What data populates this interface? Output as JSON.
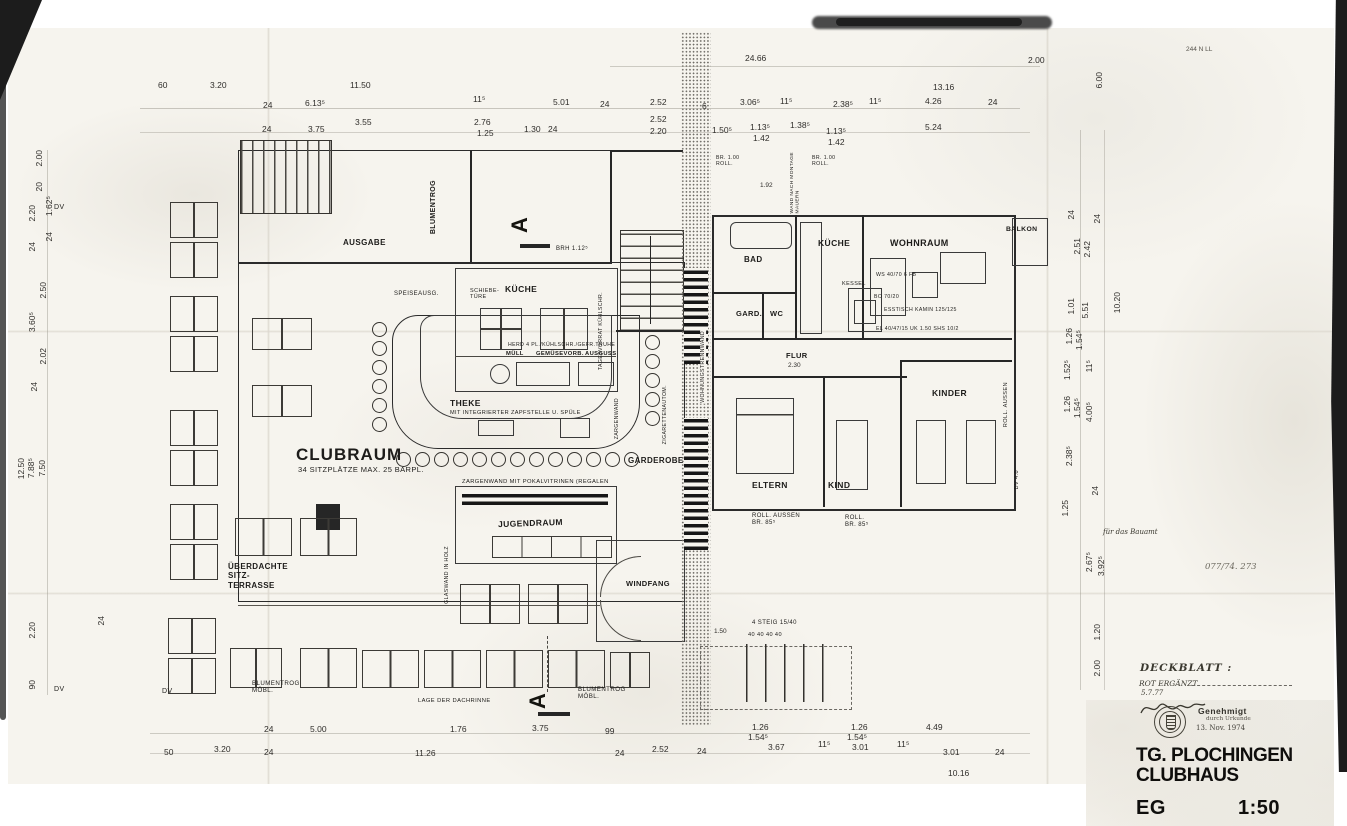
{
  "title_block": {
    "deckblatt": "DECKBLATT :",
    "revision": "ROT ERGÄNZT",
    "revision_date": "5.7.77",
    "stamp": "Genehmigt",
    "stamp_sub": "durch Urkunde",
    "stamp_date": "13. Nov. 1974",
    "project": "TG. PLOCHINGEN",
    "project2": "CLUBHAUS",
    "floor": "EG",
    "scale": "1:50"
  },
  "notes": {
    "bauamt": "für das Bauamt",
    "file_no": "077/74. 273",
    "nn": "244 N LL"
  },
  "rooms": {
    "clubraum": "CLUBRAUM",
    "clubraum_sub": "34 SITZPLÄTZE  MAX. 25 BARPL.",
    "ausgabe": "AUSGABE",
    "blumentrog": "BLUMENTROG",
    "kueche": "KÜCHE",
    "theke": "THEKE",
    "theke_sub": "MIT INTEGRIERTER ZAPFSTELLE U. SPÜLE",
    "jugendraum": "JUGENDRAUM",
    "garderobe": "GARDEROBE",
    "windfang": "WINDFANG",
    "terrasse": "ÜBERDACHTE\nSITZ-\nTERRASSE",
    "blumentrog_moebl_1": "BLUMENTROG\nMÖBL.",
    "blumentrog_moebl_2": "BLUMENTROG\nMÖBL.",
    "bad": "BAD",
    "gard": "GARD.",
    "wc": "WC",
    "flur": "FLUR",
    "kueche_whg": "KÜCHE",
    "wohnraum": "WOHNRAUM",
    "balkon": "BALKON",
    "eltern": "ELTERN",
    "kind": "KIND",
    "kinder": "KINDER",
    "kessel": "KESSEL"
  },
  "annot": {
    "zargenwand": "ZARGENWAND MIT  POKALVITRINEN (REGALEN",
    "zargenwand_v": "ZARGENWAND",
    "speiseausg": "SPEISEAUSG.",
    "schiebetuere": "SCHIEBE-\nTÜRE",
    "muell": "MÜLL",
    "gemuese": "GEMÜSEVORB.",
    "ausguss": "AUSGUSS",
    "herd": "HERD 4 PL./KÜHLSCHR./GEFR.TRUHE",
    "tagesvorrat": "TAGESVORRAT KÜHLSCHR.",
    "brh": "BRH 1.12⁵",
    "glaswand": "GLASWAND IN HOLZ",
    "zigaretten": "ZIGARETTENAUTOM.",
    "trennwand": "WOHNUNGSTRENNWAND",
    "wand_montage": "WAND NACH MONTAGE\nMAUERN",
    "br_roll_1": "BR. 1.00\nROLL.",
    "br_roll_2": "BR. 1.00\nROLL.",
    "roll_aussen_1": "ROLL. AUSSEN\nBR. 85⁵",
    "roll_2": "ROLL.\nBR. 85⁵",
    "roll_aussen_v": "ROLL. AUSSEN",
    "dv40_v": "DV 4.0",
    "steig": "4 STEIG 15/40",
    "steig_dims": "40    40    40    40",
    "lage_dachrinne": "LAGE DER DACHRINNE",
    "dv1": "DV",
    "dv2": "DV",
    "dv3": "DV",
    "section_a_top": "A",
    "section_a_bottom": "A",
    "ws": "WS 40/70  6 FB",
    "bo": "BO 70/20",
    "esstisch": "ESSTISCH KAMIN 125/125",
    "el": "EL 40/47/15  UK 1.50  SHS 10/2"
  },
  "dims": {
    "t1": [
      "60",
      "3.20",
      "11.50",
      "24.66",
      "13.16",
      "2.00"
    ],
    "t2": [
      "24",
      "6.13⁵",
      "11⁵",
      "5.01",
      "24",
      "2.52",
      "6",
      "3.06⁵",
      "11⁵",
      "2.38⁵",
      "11⁵",
      "4.26",
      "24"
    ],
    "t3": [
      "24",
      "3.75",
      "3.55",
      "2.76",
      "1.25",
      "1.30",
      "24",
      "2.52",
      "2.20",
      "1.50⁵",
      "1.13⁵",
      "1.42",
      "1.38⁵",
      "1.13⁵",
      "1.42",
      "5.24"
    ],
    "left": [
      "2.00",
      "20",
      "2.20",
      "24",
      "1.62⁵",
      "24",
      "2.50",
      "3.60⁵",
      "2.02",
      "24",
      "12.50",
      "7.88⁵",
      "7.50",
      "2.20",
      "24",
      "90"
    ],
    "right": [
      "6.00",
      "24",
      "24",
      "2.51",
      "2.42",
      "1.01",
      "5.51",
      "10.20",
      "1.26",
      "1.54⁵",
      "1.52⁵",
      "11⁵",
      "1.26",
      "1.54⁵",
      "4.00⁵",
      "2.38⁵",
      "24",
      "1.25",
      "2.67⁵",
      "3.92⁵",
      "1.20",
      "2.00"
    ],
    "b1": [
      "24",
      "5.00",
      "1.76",
      "3.75",
      "99",
      "1.26",
      "1.54⁵",
      "1.26",
      "1.54⁵",
      "4.49"
    ],
    "b2": [
      "50",
      "3.20",
      "24",
      "11.26",
      "24",
      "2.52",
      "24",
      "3.67",
      "11⁵",
      "3.01",
      "11⁵",
      "3.01",
      "24",
      "10.16"
    ],
    "misc": [
      "1.92",
      "2.30",
      "1.50"
    ]
  }
}
